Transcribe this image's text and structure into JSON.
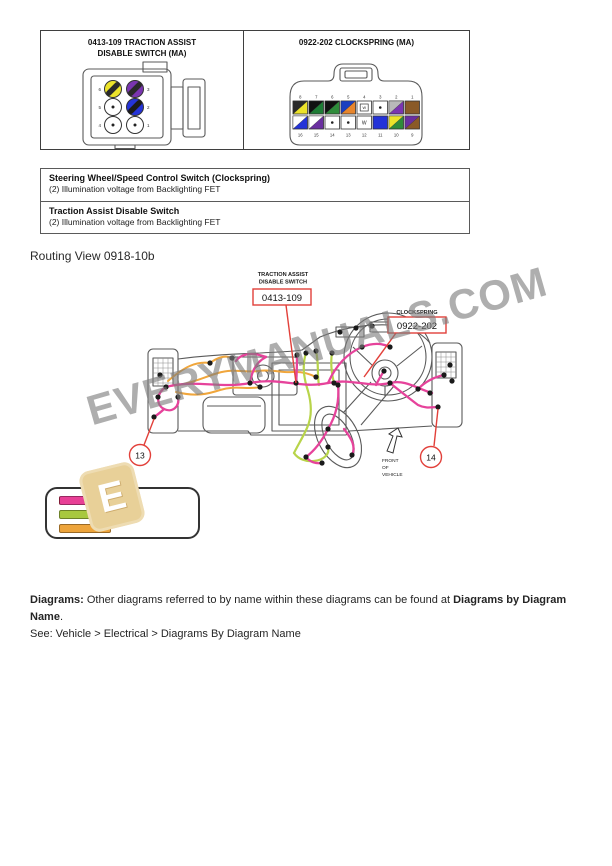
{
  "colors": {
    "callout_red": "#e2403a",
    "harness_pink": "#e6439b",
    "harness_orange": "#f0a63c",
    "harness_green": "#b8d44a",
    "logo_tan": "#e8d098"
  },
  "connector_panels": {
    "left": {
      "title_line1": "0413-109 TRACTION ASSIST",
      "title_line2": "DISABLE SWITCH (MA)",
      "pins": [
        {
          "n": "6",
          "type": "split",
          "main": "#ece32a",
          "stripe": "#2a2a2a"
        },
        {
          "n": "3",
          "type": "split",
          "main": "#7a35b0",
          "stripe": "#2a2a2a"
        },
        {
          "n": "5",
          "type": "dot",
          "main": "#ffffff",
          "stripe": ""
        },
        {
          "n": "2",
          "type": "split",
          "main": "#2433d8",
          "stripe": "#1a1a1a"
        },
        {
          "n": "4",
          "type": "dot",
          "main": "#ffffff",
          "stripe": ""
        },
        {
          "n": "1",
          "type": "dot",
          "main": "#ffffff",
          "stripe": ""
        }
      ]
    },
    "right": {
      "title": "0922-202 CLOCKSPRING (MA)",
      "top_pins": [
        {
          "n": "8",
          "type": "split",
          "main": "#ece32a",
          "stripe": "#2a2a2a"
        },
        {
          "n": "7",
          "type": "split",
          "main": "#1e7c35",
          "stripe": "#111111"
        },
        {
          "n": "6",
          "type": "split",
          "main": "#2e8b3a",
          "stripe": "#111111"
        },
        {
          "n": "5",
          "type": "split",
          "main": "#e8862c",
          "stripe": "#1b3fc0"
        },
        {
          "n": "4",
          "type": "box",
          "main": "#ffffff",
          "stripe": "",
          "mark": "W"
        },
        {
          "n": "3",
          "type": "dot",
          "main": "#ffffff",
          "stripe": ""
        },
        {
          "n": "2",
          "type": "split",
          "main": "#7a35b0",
          "stripe": "#b9b9b9"
        },
        {
          "n": "1",
          "type": "solid",
          "main": "#8a5a28",
          "stripe": ""
        }
      ],
      "bottom_pins": [
        {
          "n": "16",
          "type": "split",
          "main": "#2433d8",
          "stripe": "#ffffff"
        },
        {
          "n": "15",
          "type": "split",
          "main": "#6a2fa0",
          "stripe": "#ffffff"
        },
        {
          "n": "14",
          "type": "dot",
          "main": "#ffffff",
          "stripe": ""
        },
        {
          "n": "13",
          "type": "dot",
          "main": "#ffffff",
          "stripe": ""
        },
        {
          "n": "12",
          "type": "letter",
          "main": "#ffffff",
          "stripe": "",
          "mark": "W"
        },
        {
          "n": "11",
          "type": "solid",
          "main": "#2433d8",
          "stripe": ""
        },
        {
          "n": "10",
          "type": "split",
          "main": "#2e8b3a",
          "stripe": "#ece32a"
        },
        {
          "n": "9",
          "type": "split",
          "main": "#8a5a28",
          "stripe": "#6a2fa0"
        }
      ]
    }
  },
  "descriptions": [
    {
      "title": "Steering Wheel/Speed Control Switch (Clockspring)",
      "detail": "(2) Illumination voltage from Backlighting FET"
    },
    {
      "title": "Traction Assist Disable Switch",
      "detail": "(2) Illumination voltage from Backlighting FET"
    }
  ],
  "routing_view_label": "Routing View 0918-10b",
  "routing_diagram": {
    "label_traction": {
      "line1": "TRACTION ASSIST",
      "line2": "DISABLE SWITCH",
      "code": "0413-109"
    },
    "label_clockspring": {
      "line1": "CLOCKSPRING",
      "code": "0922-202"
    },
    "callout_left": "13",
    "callout_right": "14",
    "front_label": {
      "line1": "FRONT",
      "line2": "OF",
      "line3": "VEHICLE"
    }
  },
  "legend": {
    "bars": [
      {
        "name": "pink-harness",
        "color": "#e83f96",
        "color2": "#c62a52"
      },
      {
        "name": "green-harness",
        "color": "#a8c83f",
        "color2": "#a8c83f"
      },
      {
        "name": "orange-harness",
        "color": "#eda43b",
        "color2": "#eda43b"
      }
    ]
  },
  "watermark": {
    "text": "EVERYMANUALS.COM",
    "logo_letter": "E"
  },
  "footer": {
    "label": "Diagrams:",
    "text_mid": " Other diagrams referred to by name within these diagrams can be found at ",
    "link_name": "Diagrams by Diagram Name",
    "period": ".",
    "see_line": "See: Vehicle > Electrical > Diagrams By Diagram Name"
  }
}
